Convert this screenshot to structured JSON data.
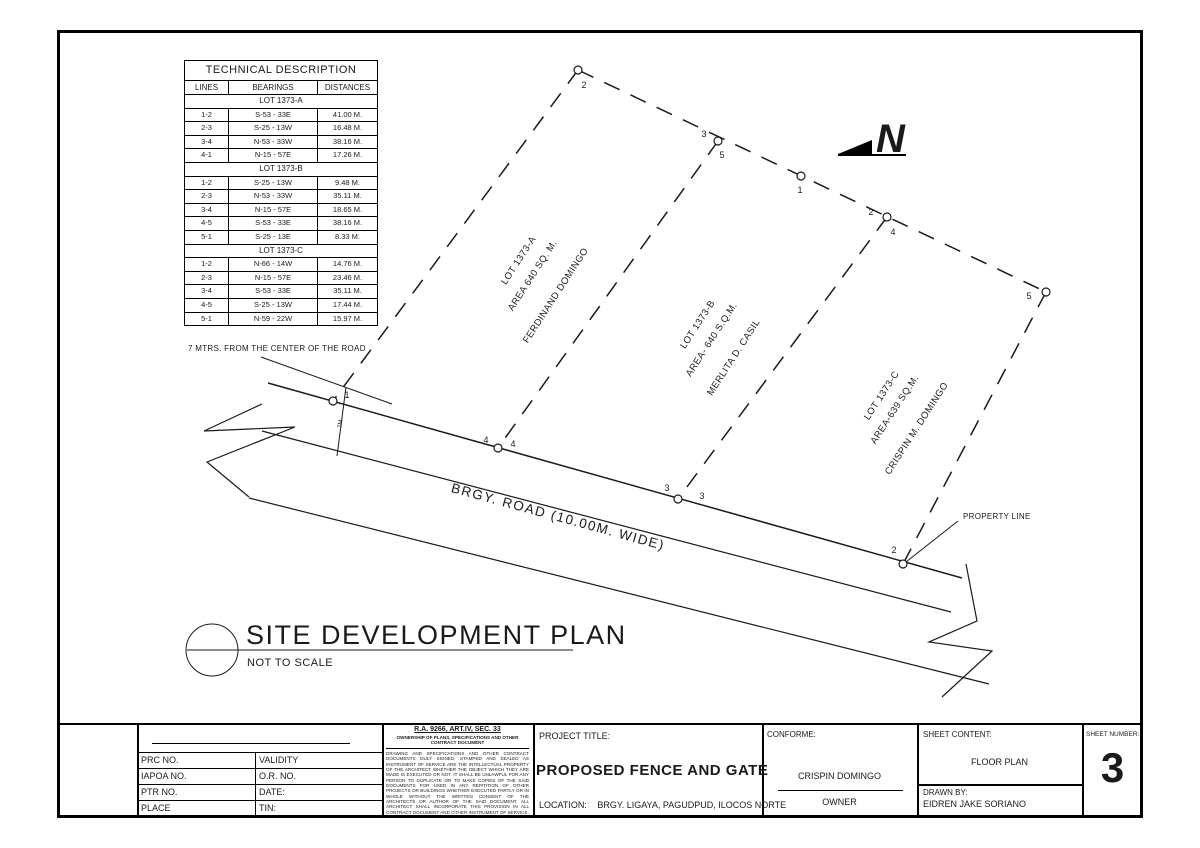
{
  "sheet": {
    "north_label": "N",
    "plan_title": "SITE DEVELOPMENT PLAN",
    "plan_subtitle": "NOT TO SCALE",
    "road_label": "BRGY. ROAD (10.00M. WIDE)",
    "setback_note": "7 MTRS. FROM THE CENTER OF THE ROAD",
    "property_line_label": "PROPERTY LINE",
    "setback_dim": "7M"
  },
  "lots": [
    {
      "name": "LOT 1373-A",
      "area": "AREA 640 SQ. M.",
      "owner": "FERDINAND DOMINGO"
    },
    {
      "name": "LOT 1373-B",
      "area": "AREA- 640 S.Q.M.",
      "owner": "MERLITA D. CASIL"
    },
    {
      "name": "LOT 1373-C",
      "area": "AREA-639 SQ.M.",
      "owner": "CRISPIN M. DOMINGO"
    }
  ],
  "vertex_labels": [
    "2",
    "3",
    "5",
    "1",
    "2",
    "4",
    "5",
    "1",
    "4",
    "4",
    "3",
    "3",
    "2"
  ],
  "tech_table": {
    "title": "TECHNICAL DESCRIPTION",
    "columns": [
      "LINES",
      "BEARINGS",
      "DISTANCES"
    ],
    "sections": [
      {
        "name": "LOT 1373-A",
        "rows": [
          [
            "1-2",
            "S-53 - 33E",
            "41.00 M."
          ],
          [
            "2-3",
            "S-25 - 13W",
            "16.48 M."
          ],
          [
            "3-4",
            "N-53 - 33W",
            "38.16 M."
          ],
          [
            "4-1",
            "N-15 - 57E",
            "17.26 M."
          ]
        ]
      },
      {
        "name": "LOT 1373-B",
        "rows": [
          [
            "1-2",
            "S-25 - 13W",
            "9.48 M."
          ],
          [
            "2-3",
            "N-53 - 33W",
            "35.11 M."
          ],
          [
            "3-4",
            "N-15 - 57E",
            "18.65 M."
          ],
          [
            "4-5",
            "S-53 - 33E",
            "38.16 M."
          ],
          [
            "5-1",
            "S-25 - 13E",
            "8.33 M."
          ]
        ]
      },
      {
        "name": "LOT 1373-C",
        "rows": [
          [
            "1-2",
            "N-66 - 14W",
            "14.76 M."
          ],
          [
            "2-3",
            "N-15 - 57E",
            "23.46 M."
          ],
          [
            "3-4",
            "S-53 - 33E",
            "35.11 M."
          ],
          [
            "4-5",
            "S-25 - 13W",
            "17.44 M."
          ],
          [
            "5-1",
            "N-59 - 22W",
            "15.97 M."
          ]
        ]
      }
    ]
  },
  "title_block": {
    "registration": {
      "rows": [
        [
          "PRC NO.",
          "VALIDITY"
        ],
        [
          "IAPOA NO.",
          "O.R. NO."
        ],
        [
          "PTR NO.",
          "DATE:"
        ],
        [
          "PLACE",
          "TIN:"
        ]
      ]
    },
    "law": {
      "heading": "R.A. 9266, ART.IV, SEC. 33",
      "subheading": "OWNERSHIP OF PLANS, SPECIFICATIONS AND OTHER CONTRACT DOCUMENT",
      "body": "DRAWING AND SPECIFICATIONS AND OTHER CONTRACT DOCUMENTS DULY SIGNED, STAMPED AND SEALED AS INSTRUMENT OF SERVICE ARE THE INTELLECTUAL PROPERTY OF THE ARCHITECT WHETHER THE OBJECT WHICH THEY ARE MADE IS EXECUTED OR NOT. IT SHALL BE UNLAWFUL FOR ANY PERSON TO DUPLICATE OR TO MAKE COPIES OF THE SAID DOCUMENTS FOR USED IN ANY REPITITION OF OTHER PROJECTS OR BUILDINGS WHETHER EXECUTED PARTLY OR IN WHOLE WITHOUT THE WRITTEN CONSENT OF THE ARCHITECTS OR AUTHOR OF THE SAID DOCUMENT. ALL ARCHITECT SHALL INCORPORATE THIS PROVISION IN ALL CONTRACT DOCUMENT AND OTHER INSTRUMENT OF SERVICE."
    },
    "project": {
      "label": "PROJECT TITLE:",
      "title": "PROPOSED FENCE AND GATE",
      "location_label": "LOCATION:",
      "location": "BRGY. LIGAYA, PAGUDPUD, ILOCOS NORTE"
    },
    "conforme": {
      "label": "CONFORME:",
      "name": "CRISPIN DOMINGO",
      "role": "OWNER"
    },
    "sheet_content": {
      "label": "SHEET CONTENT:",
      "content": "FLOOR PLAN",
      "drawn_by_label": "DRAWN BY:",
      "drawn_by": "EIDREN JAKE SORIANO"
    },
    "sheet_number": {
      "label": "SHEET NUMBER:",
      "number": "3"
    }
  }
}
